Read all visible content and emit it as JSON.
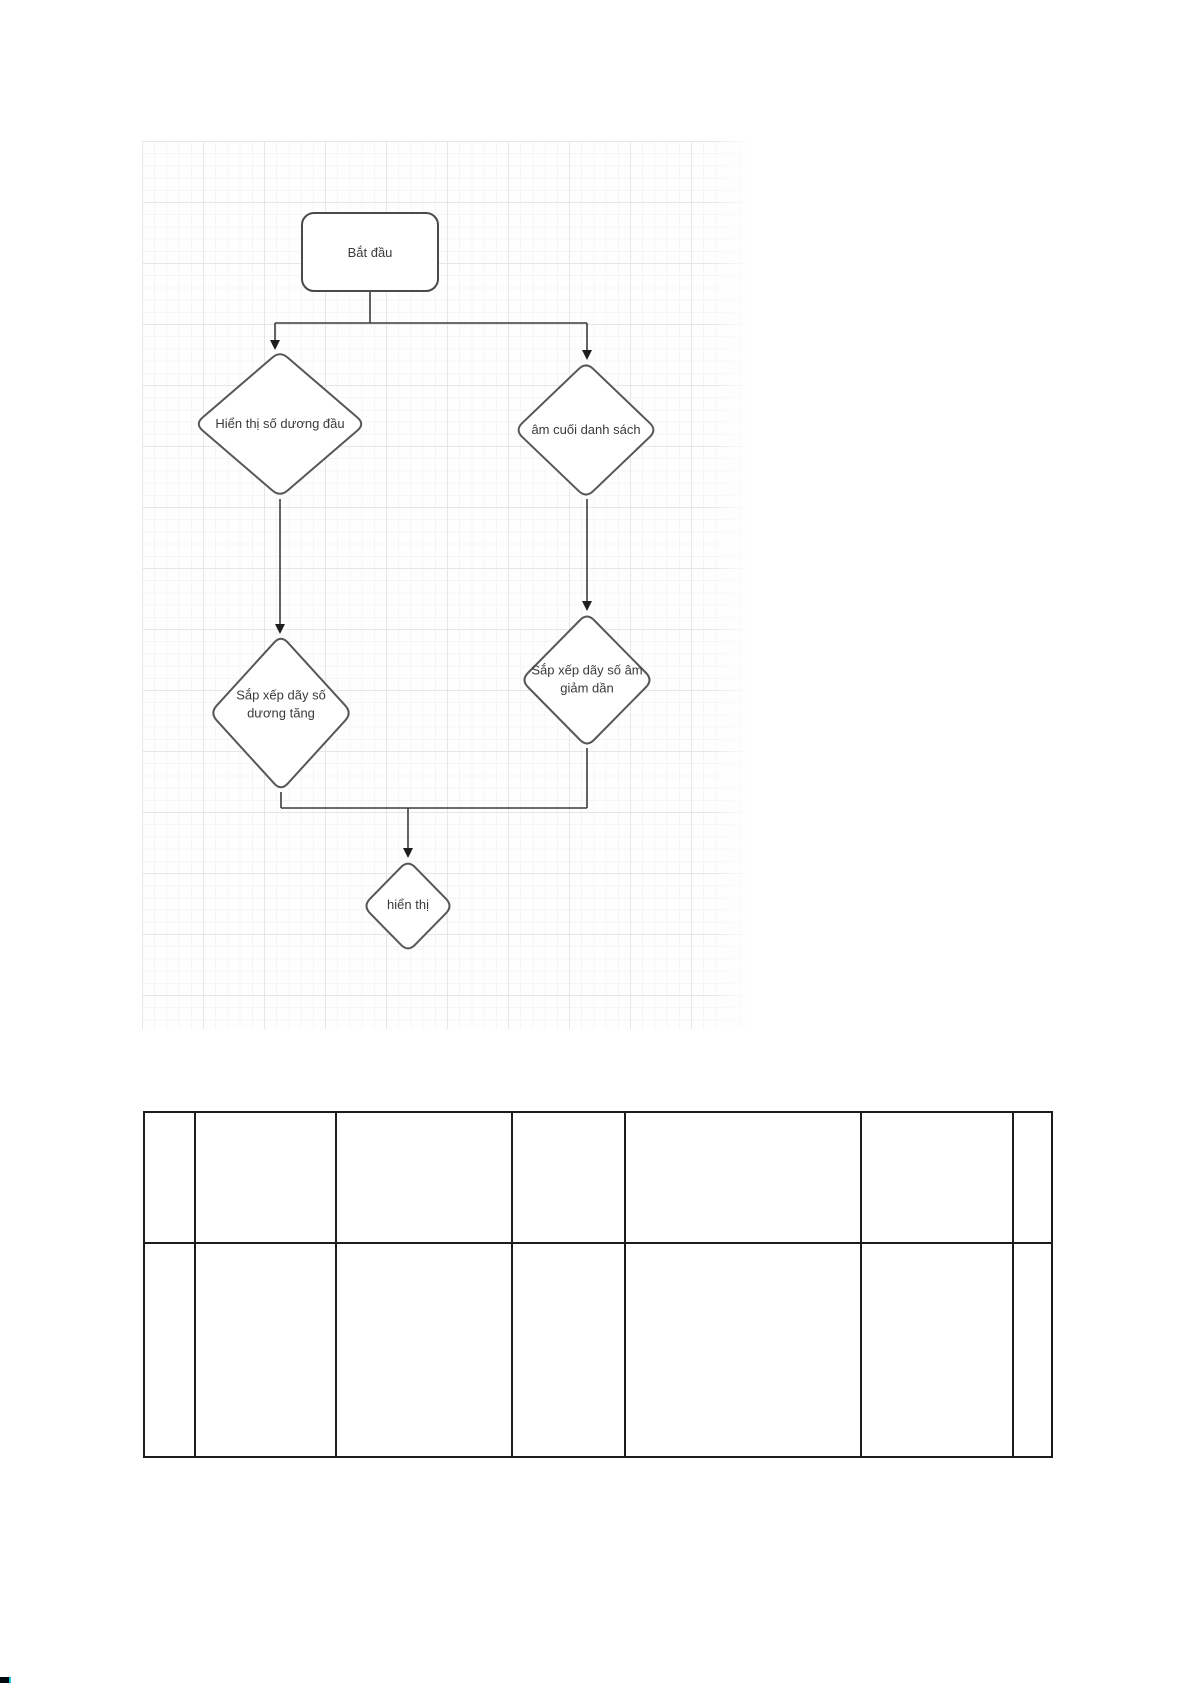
{
  "document": {
    "background": "#ffffff",
    "corner_mark": {
      "color": "#000a10",
      "accent": "#19c8d8"
    }
  },
  "flowchart": {
    "canvas": {
      "grid_minor_color": "#f5f5f5",
      "grid_major_color": "#e7e7e7",
      "background": "#fefefe"
    },
    "style": {
      "node_fill": "#ffffff",
      "node_border": "#545454",
      "connector_color": "#3c3c3c",
      "text_color": "#3a3a3a"
    },
    "nodes": {
      "start": {
        "label": "Bắt đầu",
        "shape": "rounded-rectangle"
      },
      "top_left": {
        "label": "Hiển thị số dương đầu",
        "shape": "diamond"
      },
      "top_right": {
        "label": "âm cuối danh sách",
        "shape": "diamond"
      },
      "mid_left": {
        "label": "Sắp xếp dãy số dương tăng",
        "shape": "diamond"
      },
      "mid_right": {
        "label": "Sắp xếp dãy số âm giảm dần",
        "shape": "diamond"
      },
      "end": {
        "label": "hiển thị",
        "shape": "diamond"
      }
    },
    "edges": [
      {
        "from": "start",
        "to": "top_left"
      },
      {
        "from": "start",
        "to": "top_right"
      },
      {
        "from": "top_left",
        "to": "mid_left"
      },
      {
        "from": "top_right",
        "to": "mid_right"
      },
      {
        "from": "mid_left",
        "to": "end"
      },
      {
        "from": "mid_right",
        "to": "end"
      }
    ]
  },
  "table": {
    "border_color": "#1c1c1c",
    "rows": 2,
    "columns": 7,
    "cells": [
      [
        "",
        "",
        "",
        "",
        "",
        "",
        ""
      ],
      [
        "",
        "",
        "",
        "",
        "",
        "",
        ""
      ]
    ]
  }
}
